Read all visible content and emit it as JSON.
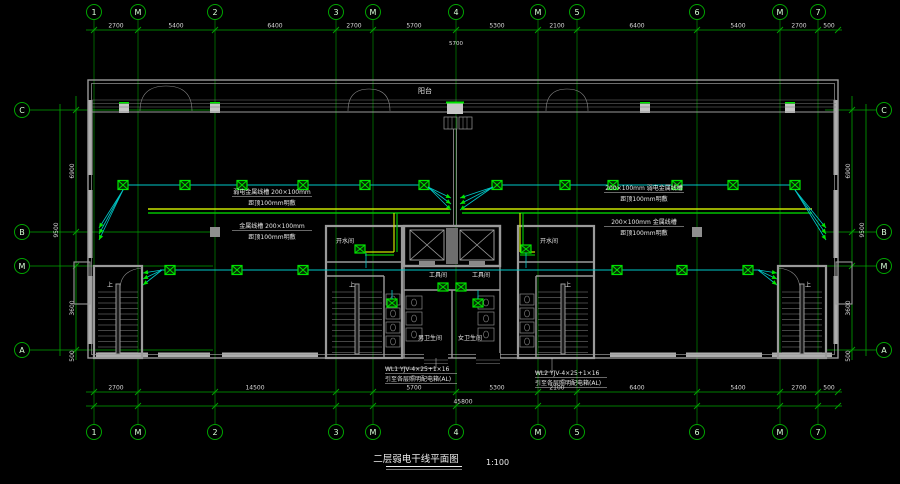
{
  "title": {
    "text": "二层弱电干线平面图",
    "scale": "1:100"
  },
  "colors": {
    "axis": "#00a400",
    "bubble_text": "#d6ffd6",
    "dim_text": "#d9d9d9",
    "wall": "#9a9a9a",
    "wall_light": "#c6c6c6",
    "wire": "#00c8c8",
    "device": "#00e400",
    "tray_a": "#c8e400",
    "tray_b": "#00c000",
    "text": "#e6e6e6"
  },
  "axes": {
    "top_bubbles": [
      [
        "1",
        94
      ],
      [
        "M",
        138
      ],
      [
        "2",
        215
      ],
      [
        "3",
        336
      ],
      [
        "M",
        373
      ],
      [
        "4",
        456
      ],
      [
        "M",
        538
      ],
      [
        "5",
        577
      ],
      [
        "6",
        697
      ],
      [
        "M",
        780
      ],
      [
        "7",
        818
      ]
    ],
    "top_dims": [
      [
        "2700",
        116
      ],
      [
        "5400",
        176
      ],
      [
        "6400",
        275
      ],
      [
        "2700",
        354
      ],
      [
        "5700",
        414
      ],
      [
        "5300",
        497
      ],
      [
        "2100",
        557
      ],
      [
        "6400",
        637
      ],
      [
        "5400",
        738
      ],
      [
        "2700",
        799
      ],
      [
        "500",
        829
      ]
    ],
    "top_extra_dim": [
      "5700",
      456
    ],
    "bottom_dims": [
      [
        "2700",
        116
      ],
      [
        "14500",
        255
      ],
      [
        "5700",
        414
      ],
      [
        "5300",
        497
      ],
      [
        "2100",
        557
      ],
      [
        "6400",
        637
      ],
      [
        "5400",
        738
      ],
      [
        "2700",
        799
      ],
      [
        "500",
        829
      ]
    ],
    "bottom_total": [
      "45800",
      463
    ],
    "left_bubbles": [
      [
        "C",
        110
      ],
      [
        "B",
        232
      ],
      [
        "M",
        266
      ],
      [
        "A",
        350
      ]
    ],
    "left_dims": [
      [
        "6900",
        171
      ],
      [
        "3600",
        308
      ],
      [
        "500",
        356
      ]
    ],
    "left_total": [
      "9500",
      230
    ],
    "right_bubbles": [
      [
        "C",
        110
      ],
      [
        "B",
        232
      ],
      [
        "M",
        266
      ],
      [
        "A",
        350
      ]
    ],
    "right_dims": [
      [
        "6900",
        171
      ],
      [
        "3600",
        308
      ],
      [
        "500",
        356
      ]
    ],
    "right_total": [
      "9500",
      230
    ]
  },
  "room_labels": [
    [
      "阳台",
      425,
      93,
      7
    ],
    [
      "开水间",
      345,
      243,
      6
    ],
    [
      "开水间",
      549,
      243,
      6
    ],
    [
      "工具间",
      438,
      277,
      6
    ],
    [
      "工具间",
      481,
      277,
      6
    ],
    [
      "男卫生间",
      430,
      340,
      6
    ],
    [
      "女卫生间",
      470,
      340,
      6
    ],
    [
      "上",
      110,
      287,
      6
    ],
    [
      "上",
      352,
      287,
      6
    ],
    [
      "上",
      568,
      287,
      6
    ],
    [
      "上",
      808,
      287,
      6
    ]
  ],
  "annotations": [
    {
      "x": 272,
      "y": 194,
      "lines": [
        "弱电金属线槽 200×100mm",
        "距顶100mm明敷"
      ]
    },
    {
      "x": 272,
      "y": 228,
      "lines": [
        "金属线槽 200×100mm",
        "距顶100mm明敷"
      ]
    },
    {
      "x": 644,
      "y": 190,
      "lines": [
        "200×100mm 弱电金属线槽",
        "距顶100mm明敷"
      ]
    },
    {
      "x": 644,
      "y": 224,
      "lines": [
        "200×100mm 金属线槽",
        "距顶100mm明敷"
      ]
    }
  ],
  "callouts": [
    {
      "x": 385,
      "y": 371,
      "lines": [
        "WL1 YJV-4×25+1×16",
        "引至各层照明配电箱(AL)"
      ]
    },
    {
      "x": 535,
      "y": 375,
      "lines": [
        "WL2 YJV-4×25+1×16",
        "引至各层照明配电箱(AL)"
      ]
    }
  ],
  "detector_runs": [
    {
      "y": 185,
      "x1": 123,
      "x2": 424,
      "boxes": [
        123,
        185,
        242,
        303,
        365,
        424
      ]
    },
    {
      "y": 185,
      "x1": 497,
      "x2": 795,
      "boxes": [
        497,
        565,
        613,
        677,
        733,
        795
      ]
    },
    {
      "y": 270,
      "x1": 160,
      "x2": 760,
      "boxes": [
        170,
        237,
        303,
        617,
        682,
        748
      ]
    }
  ],
  "arrow_fans": [
    {
      "x": 123,
      "y": 190,
      "tips": [
        [
          99,
          228
        ],
        [
          99,
          234
        ],
        [
          99,
          240
        ]
      ]
    },
    {
      "x": 162,
      "y": 270,
      "tips": [
        [
          143,
          273
        ],
        [
          143,
          279
        ],
        [
          143,
          285
        ]
      ]
    },
    {
      "x": 428,
      "y": 187,
      "tips": [
        [
          451,
          198
        ],
        [
          451,
          204
        ],
        [
          451,
          210
        ]
      ]
    },
    {
      "x": 493,
      "y": 187,
      "tips": [
        [
          460,
          198
        ],
        [
          460,
          204
        ],
        [
          460,
          210
        ]
      ]
    },
    {
      "x": 758,
      "y": 270,
      "tips": [
        [
          777,
          273
        ],
        [
          777,
          279
        ],
        [
          777,
          285
        ]
      ]
    },
    {
      "x": 795,
      "y": 190,
      "tips": [
        [
          826,
          228
        ],
        [
          826,
          234
        ],
        [
          826,
          240
        ]
      ]
    }
  ],
  "devices": [
    [
      360,
      249
    ],
    [
      526,
      249
    ],
    [
      392,
      303
    ],
    [
      478,
      303
    ],
    [
      443,
      287
    ],
    [
      461,
      287
    ]
  ],
  "tray": {
    "mains": [
      [
        148,
        209,
        450
      ],
      [
        462,
        209,
        812
      ]
    ],
    "verticals": [
      [
        394,
        213,
        252
      ],
      [
        520,
        213,
        252
      ]
    ],
    "branches": [
      [
        252,
        365,
        394
      ],
      [
        252,
        520,
        535
      ]
    ]
  },
  "columns": {
    "top": [
      124,
      215,
      645,
      790
    ],
    "interior": [
      [
        215,
        232
      ],
      [
        697,
        232
      ]
    ]
  },
  "window_strips": {
    "bottom": [
      [
        96,
        148
      ],
      [
        158,
        210
      ],
      [
        222,
        318
      ],
      [
        610,
        676
      ],
      [
        686,
        762
      ],
      [
        772,
        832
      ]
    ],
    "left": [
      [
        100,
        175
      ],
      [
        190,
        258
      ],
      [
        276,
        344
      ]
    ],
    "right": [
      [
        100,
        175
      ],
      [
        190,
        258
      ],
      [
        276,
        344
      ]
    ]
  }
}
